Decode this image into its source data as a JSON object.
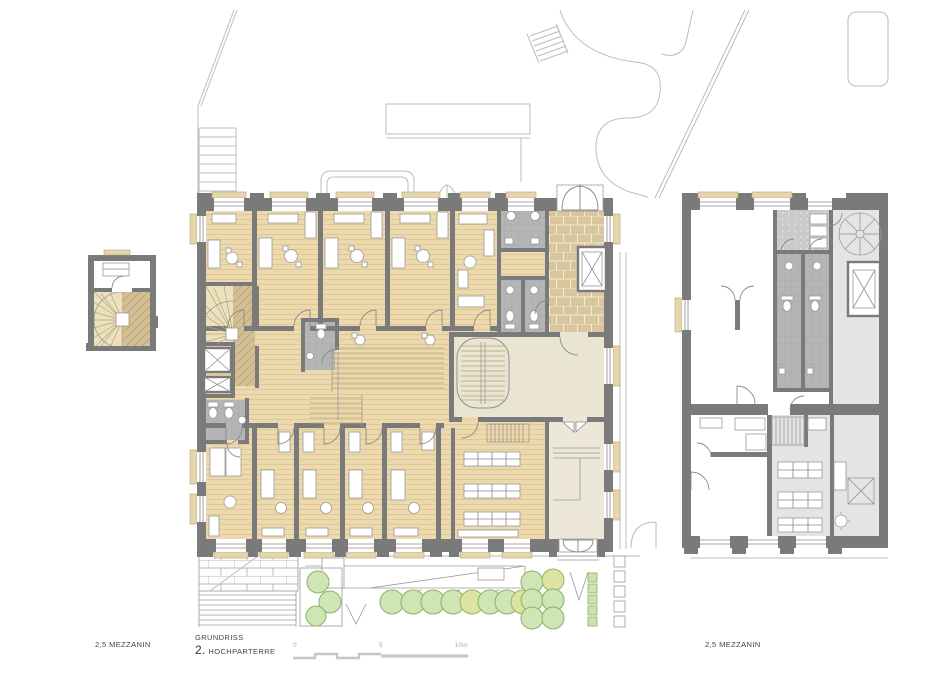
{
  "annotations": {
    "left_label": "2,5 MEZZANIN",
    "right_label": "2,5 MEZZANIN",
    "title_line1": "GRUNDRISS",
    "title_number": "2.",
    "title_line2": "HOCHPARTERRE"
  },
  "scale_bar": {
    "tick_0": "0",
    "tick_5": "5",
    "tick_10": "10m"
  },
  "colors": {
    "background": "#ffffff",
    "walls": "#7a7a7a",
    "wood_floor": "#ecd9ae",
    "wood_line": "#dcc48f",
    "stair_hall_beige": "#eae4d3",
    "annex_cream": "#ece7d9",
    "bathroom_tile_gray": "#b5b5b5",
    "anteroom_gray": "#cacaca",
    "light_gray_room": "#e4e4e4",
    "parquet_tan": "#d9c69c",
    "window_sill": "#e6d6ac",
    "context_line": "#bcbcbc",
    "tree_green": "#cfe6b4",
    "tree_yellow_green": "#dde3a0",
    "label_text": "#444444",
    "scale_text": "#a9a9a9"
  }
}
